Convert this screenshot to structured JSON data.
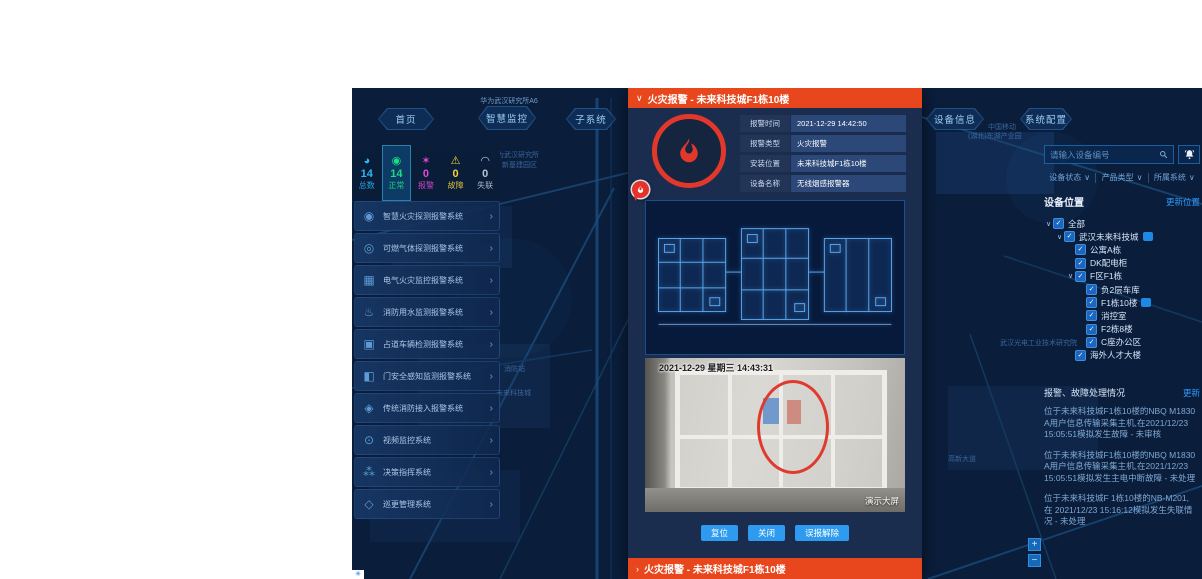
{
  "nav": {
    "home": "首页",
    "site": "华为武汉研究所A6",
    "monitor": "智慧监控",
    "subsystem": "子系统",
    "device_info": "设备信息",
    "system_config": "系统配置"
  },
  "stats": {
    "items": [
      {
        "key": "total",
        "label": "总数",
        "value": "14",
        "color": "#2fb6f3",
        "icon": "pie-chart-icon"
      },
      {
        "key": "normal",
        "label": "正常",
        "value": "14",
        "color": "#17e07f",
        "icon": "signal-icon",
        "active": true
      },
      {
        "key": "alarm",
        "label": "报警",
        "value": "0",
        "color": "#e546d8",
        "icon": "alarm-star-icon"
      },
      {
        "key": "fault",
        "label": "故障",
        "value": "0",
        "color": "#f3d23a",
        "icon": "warning-icon"
      },
      {
        "key": "offline",
        "label": "失联",
        "value": "0",
        "color": "#b7c6d4",
        "icon": "wifi-icon"
      }
    ]
  },
  "systems": [
    {
      "label": "智慧火灾探测报警系统",
      "icon": "smoke-detector-icon"
    },
    {
      "label": "可燃气体探测报警系统",
      "icon": "gas-detector-icon"
    },
    {
      "label": "电气火灾监控报警系统",
      "icon": "electric-panel-icon"
    },
    {
      "label": "消防用水监测报警系统",
      "icon": "water-monitor-icon"
    },
    {
      "label": "占道车辆检测报警系统",
      "icon": "vehicle-icon"
    },
    {
      "label": "门安全感知监测报警系统",
      "icon": "door-icon"
    },
    {
      "label": "传统消防接入报警系统",
      "icon": "hydrant-icon"
    },
    {
      "label": "视频监控系统",
      "icon": "camera-icon"
    },
    {
      "label": "决策指挥系统",
      "icon": "command-icon"
    },
    {
      "label": "巡更管理系统",
      "icon": "patrol-icon"
    }
  ],
  "alarm_modal": {
    "title": "火灾报警 - 未来科技城F1栋10楼",
    "info_rows": [
      {
        "label": "报警时间",
        "value": "2021-12-29 14:42:50"
      },
      {
        "label": "报警类型",
        "value": "火灾报警"
      },
      {
        "label": "安装位置",
        "value": "未来科技城F1栋10楼"
      },
      {
        "label": "设备名称",
        "value": "无线烟感报警器"
      }
    ],
    "camera_timestamp": "2021-12-29 星期三 14:43:31",
    "camera_watermark": "演示大屏",
    "buttons": [
      "复位",
      "关闭",
      "误报解除"
    ],
    "collapsed_title": "火灾报警 - 未来科技城F1栋10楼"
  },
  "right_panel": {
    "search_placeholder": "请输入设备编号",
    "filters": [
      "设备状态",
      "产品类型",
      "所属系统"
    ],
    "location_title": "设备位置",
    "update_location_link": "更新位置",
    "tree": [
      {
        "label": "全部",
        "level": 0,
        "expanded": true,
        "checked": true
      },
      {
        "label": "武汉未来科技城",
        "level": 1,
        "expanded": true,
        "checked": true,
        "badge": true
      },
      {
        "label": "公寓A栋",
        "level": 2,
        "checked": true
      },
      {
        "label": "DK配电柜",
        "level": 2,
        "checked": true
      },
      {
        "label": "F区F1栋",
        "level": 2,
        "expanded": true,
        "checked": true
      },
      {
        "label": "负2层车库",
        "level": 3,
        "checked": true
      },
      {
        "label": "F1栋10楼",
        "level": 3,
        "checked": true,
        "badge": true
      },
      {
        "label": "消控室",
        "level": 3,
        "checked": true
      },
      {
        "label": "F2栋8楼",
        "level": 3,
        "checked": true
      },
      {
        "label": "C座办公区",
        "level": 3,
        "checked": true
      },
      {
        "label": "海外人才大楼",
        "level": 2,
        "checked": true
      }
    ],
    "status_title": "报警、故障处理情况",
    "refresh_link": "更新",
    "messages": [
      "位于未来科技城F1栋10楼的NBQ M1830 A用户信息传输采集主机,在2021/12/23 15:05:51模拟发生故障 - 未审核",
      "位于未来科技城F1栋10楼的NBQ M1830 A用户信息传输采集主机,在2021/12/23 15:05:51模拟发生主电中断故障 - 未处理",
      "位于未来科技城F 1栋10楼的NB-M201,在 2021/12/23 15:16:12模拟发生失联情况 - 未处理"
    ]
  },
  "map": {
    "labels": [
      {
        "text": "华为武汉研究所",
        "x": 138,
        "y": 62
      },
      {
        "text": "新基建园区",
        "x": 150,
        "y": 72
      },
      {
        "text": "中国移动",
        "x": 636,
        "y": 34
      },
      {
        "text": "(湖北)东湖产业园",
        "x": 616,
        "y": 43
      },
      {
        "text": "消防站",
        "x": 152,
        "y": 276
      },
      {
        "text": "未来科技城",
        "x": 144,
        "y": 300
      },
      {
        "text": "武汉光电工业技术研究院",
        "x": 648,
        "y": 250
      },
      {
        "text": "高新大道",
        "x": 596,
        "y": 366
      }
    ],
    "zoom_in": "+",
    "zoom_out": "−"
  }
}
